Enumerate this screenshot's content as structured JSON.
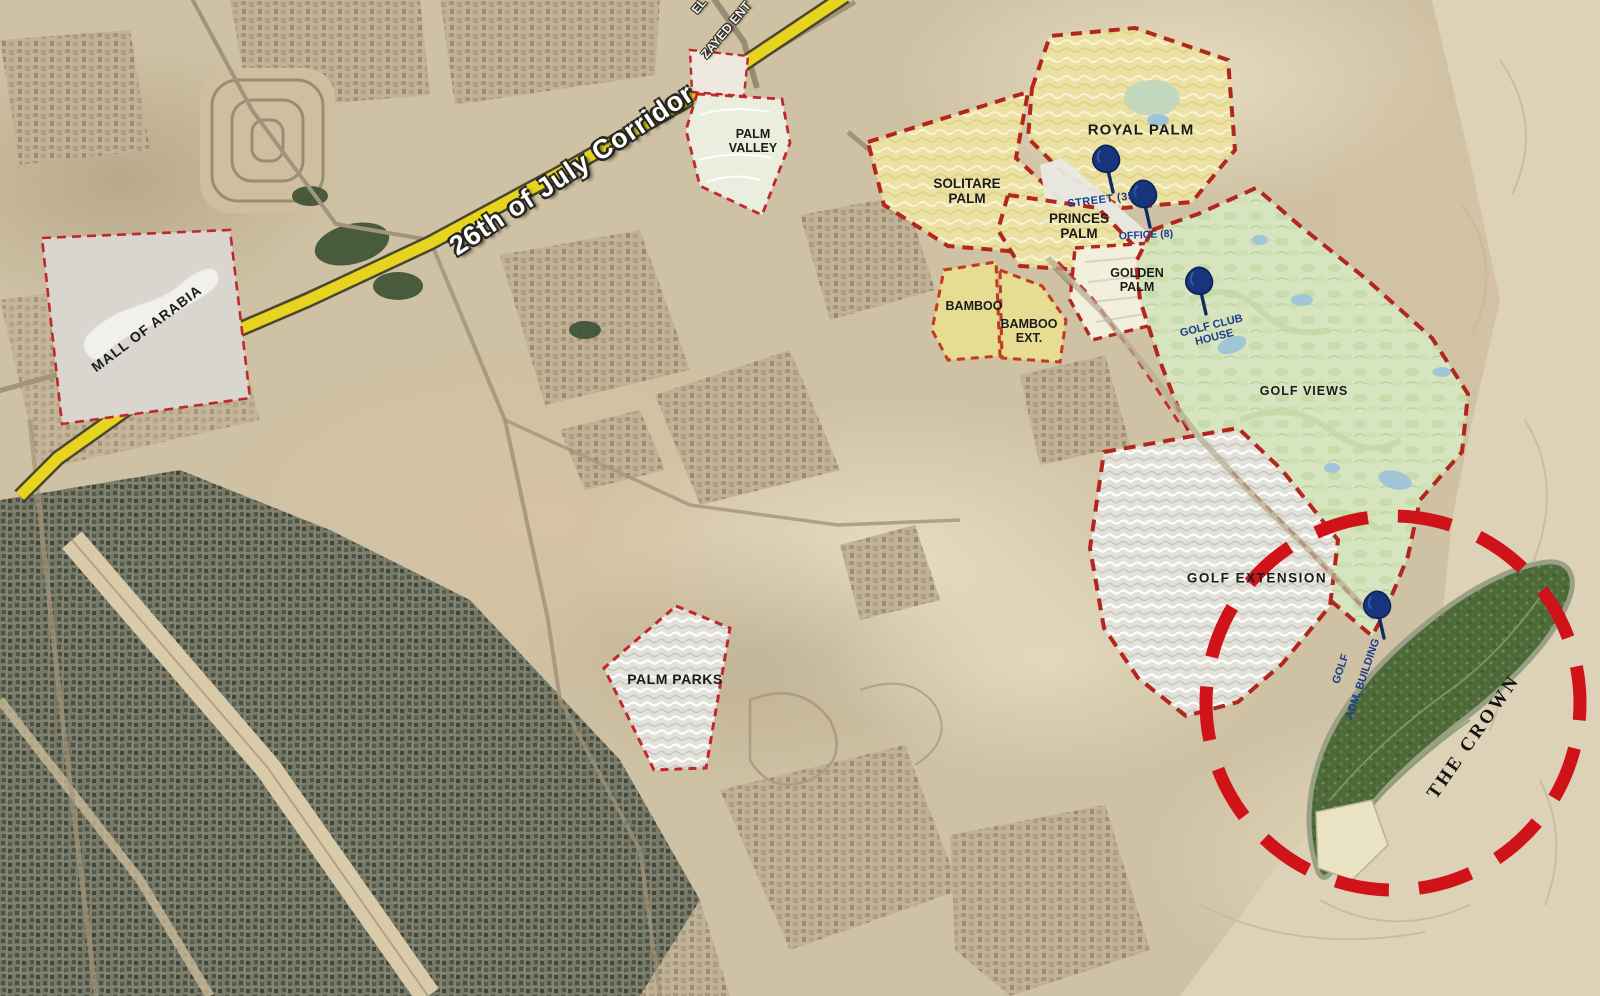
{
  "road": {
    "label": "26th of July Corridor"
  },
  "entrance": {
    "line1": "EL",
    "line2": "ZAYED ENT"
  },
  "zones": {
    "mall_of_arabia": "MALL OF ARABIA",
    "palm_valley": "PALM VALLEY",
    "solitare_palm": "SOLITARE PALM",
    "royal_palm": "ROYAL PALM",
    "princes_palm": "PRINCES PALM",
    "bamboo": "BAMBOO",
    "bamboo_ext": "BAMBOO EXT.",
    "golden_palm": "GOLDEN PALM",
    "golf_views": "GOLF VIEWS",
    "golf_extension": "GOLF EXTENSION",
    "palm_parks": "PALM PARKS",
    "the_crown": "THE CROWN"
  },
  "poi": {
    "street": "STREET (35)",
    "office": "OFFICE (8)",
    "golf_club_house": "GOLF CLUB HOUSE",
    "golf_adm_line1": "GOLF",
    "golf_adm_line2": "ADM. BUILDING"
  },
  "markers": {
    "pin_count": 4
  },
  "colors": {
    "boundary_red": "#c1272d",
    "highlight_circle_red": "#cf1318",
    "corridor_yellow": "#e6d41e",
    "pin_blue": "#17357c",
    "poi_label_blue": "#1c3d8c",
    "golf_green": "#d7e4c0",
    "crown_green": "#4e6a38",
    "palm_zone_yellow": "#eae1a2",
    "desert_tan": "#cfc1a3"
  }
}
